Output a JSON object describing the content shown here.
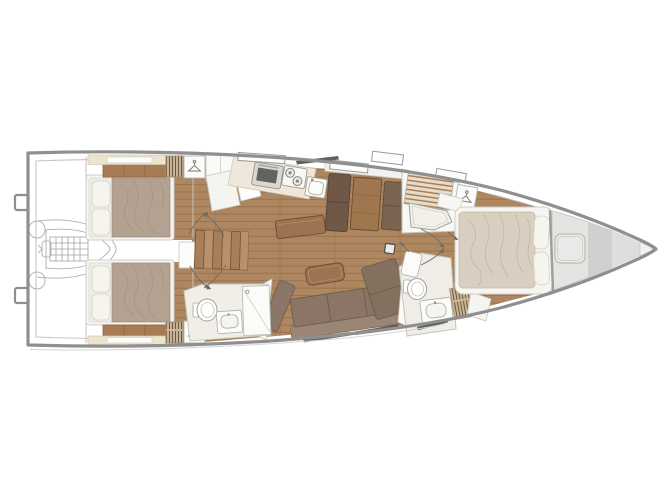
{
  "meta": {
    "title": "Sailing yacht interior deck plan, bow pointing right",
    "type": "floor-plan",
    "orientation": "bow-right"
  },
  "colors": {
    "hull_outline": "#8f8f8f",
    "deck_line": "#c6c6c6",
    "floor_wood": "#ae8660",
    "plank_line": "#96724d",
    "table_wood": "#9c7451",
    "island_wood": "#9c7451",
    "stair_wood": "#a97f58",
    "sofa_seat": "#8a7566",
    "sofa_back": "#9b8574",
    "chaise": "#84705f",
    "dinette_bench_dark": "#6f5847",
    "dinette_bench_mid": "#7a6452",
    "aft_bed_duvet": "#b3a191",
    "fwd_bed_duvet": "#d8cfc0",
    "pillow": "#f6f4ef",
    "cream_panel": "#ece4cf",
    "locker_tan": "#cdb795",
    "white_furniture": "#fbfbf9",
    "head_floor": "#efede6",
    "bow_gray": "#e4e4e2",
    "bow_gray_dark": "#d0d0ce",
    "window_dark": "#4f4f4a"
  },
  "rooms": {
    "transom": {
      "label": "Transom and swim platform"
    },
    "tender_garage": {
      "label": "Tender garage with dinghy and outboard engine"
    },
    "aft_cabin_port": {
      "label": "Aft cabin port side, double berth with pillows aft"
    },
    "aft_cabin_starboard": {
      "label": "Aft cabin starboard side, double berth with pillows aft"
    },
    "companionway": {
      "label": "Companionway stairs to saloon"
    },
    "galley": {
      "label": "Galley with oven, two-burner stove and sink"
    },
    "dinette": {
      "label": "Dinette with two facing settees and table"
    },
    "saloon": {
      "label": "Saloon with L-shaped sofa and coffee table"
    },
    "aft_head": {
      "label": "Aft head with toilet, washbasin and shower stall"
    },
    "fwd_shower": {
      "label": "Forward shower room with teak grating and shower pan"
    },
    "fwd_head": {
      "label": "Forward head with toilet, washbasin and louvered locker"
    },
    "fwd_cabin": {
      "label": "Forward owner's cabin with island double berth"
    },
    "bow_locker": {
      "label": "Forepeak sail locker with deck hatch"
    }
  },
  "furniture": {
    "mast": {
      "label": "Mast base"
    },
    "coffee_table": {
      "label": "Coffee table"
    },
    "wardrobes": {
      "label": "Hanging locker with clothes-hanger symbol"
    },
    "dinghy": {
      "label": "Stowed tender with outboard engine (outline)"
    },
    "hatches": {
      "label": "Deck hatches"
    },
    "hull_windows": {
      "label": "Hull windows"
    }
  }
}
